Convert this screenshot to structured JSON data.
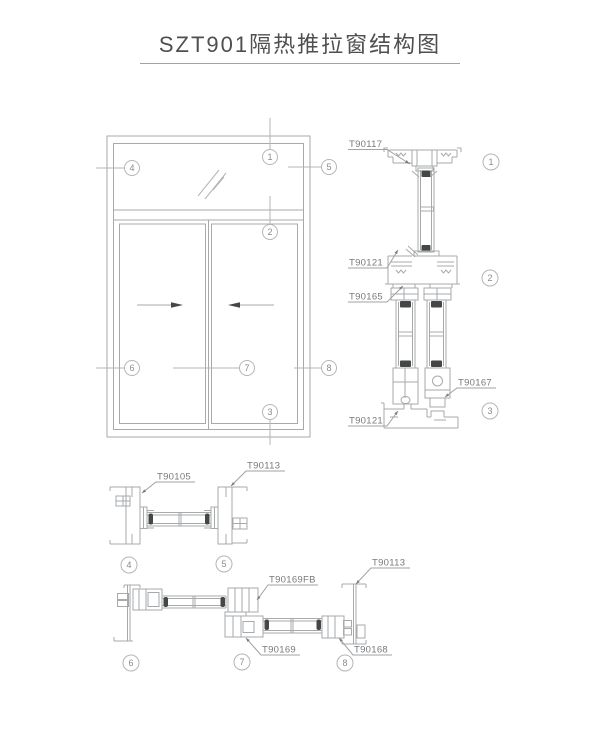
{
  "title": "SZT901隔热推拉窗结构图",
  "colors": {
    "drawing_line": "#a7a9ab",
    "light_line": "#b4b5b7",
    "label_text": "#77797b",
    "gasket_dark": "#454646",
    "title_text": "#4f4f51",
    "background": "#ffffff"
  },
  "balloons": [
    "1",
    "2",
    "3",
    "4",
    "5",
    "6",
    "7",
    "8"
  ],
  "elevation": {
    "slide_arrows": [
      "right",
      "left"
    ]
  },
  "part_labels": [
    {
      "id": "head-frame",
      "text": "T90117"
    },
    {
      "id": "transom",
      "text": "T90121"
    },
    {
      "id": "sash-top",
      "text": "T90165"
    },
    {
      "id": "sash-bottom-right",
      "text": "T90167"
    },
    {
      "id": "sill-track",
      "text": "T90121"
    },
    {
      "id": "fixed-jamb-left",
      "text": "T90105"
    },
    {
      "id": "fixed-jamb-right",
      "text": "T90113"
    },
    {
      "id": "meeting-stile",
      "text": "T90169FB"
    },
    {
      "id": "slide-jamb-right",
      "text": "T90113"
    },
    {
      "id": "sash-interlock",
      "text": "T90169"
    },
    {
      "id": "sash-end",
      "text": "T90168"
    }
  ]
}
